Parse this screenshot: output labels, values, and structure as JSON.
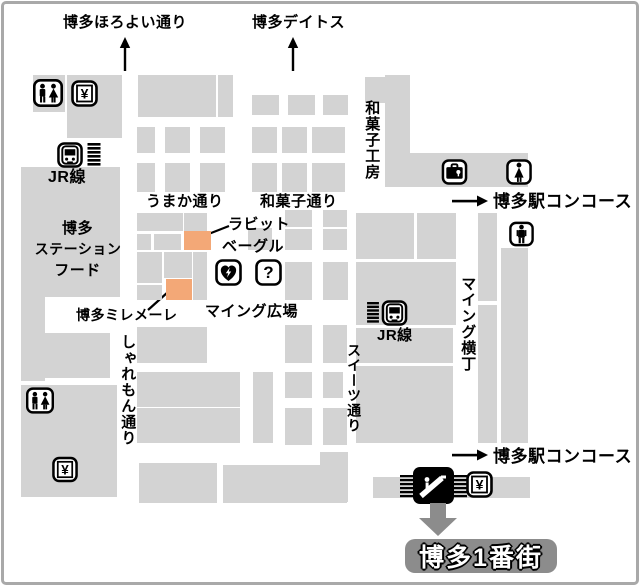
{
  "map": {
    "title": "博多駅 マイング 構内マップ",
    "destination_badge": "博多1番街",
    "colors": {
      "building": "#d3d3d3",
      "highlight": "#f3a877",
      "badge": "#8c8c8c",
      "arrow_gray": "#8c8c8c",
      "frame_border": "#a9a9a9",
      "ink": "#000000"
    },
    "labels": [
      {
        "id": "horoyoi-dori",
        "text": "博多ほろよい通り",
        "x": 63,
        "y": 14,
        "fs": 15
      },
      {
        "id": "deitos",
        "text": "博多デイトス",
        "x": 252,
        "y": 14,
        "fs": 15
      },
      {
        "id": "wagashi-kobo",
        "text": "和菓子工房",
        "x": 363,
        "y": 100,
        "fs": 15,
        "v": 1
      },
      {
        "id": "jr-line-left",
        "text": "JR線",
        "x": 48,
        "y": 169,
        "fs": 16
      },
      {
        "id": "umaka-dori",
        "text": "うまか通り",
        "x": 146,
        "y": 193,
        "fs": 15
      },
      {
        "id": "wagashi-dori",
        "text": "和菓子通り",
        "x": 260,
        "y": 193,
        "fs": 15
      },
      {
        "id": "concourse-top",
        "text": "博多駅コンコース",
        "x": 493,
        "y": 192,
        "fs": 17
      },
      {
        "id": "rabbit-bagel-1",
        "text": "ラビット",
        "x": 228,
        "y": 216,
        "fs": 15
      },
      {
        "id": "rabbit-bagel-2",
        "text": "ベーグル",
        "x": 222,
        "y": 238,
        "fs": 15
      },
      {
        "id": "station-food-1",
        "text": "博多",
        "x": 40,
        "y": 220,
        "fs": 15,
        "w": 75
      },
      {
        "id": "station-food-2",
        "text": "ステーション",
        "x": 33,
        "y": 241,
        "fs": 14,
        "w": 90
      },
      {
        "id": "station-food-3",
        "text": "フード",
        "x": 40,
        "y": 262,
        "fs": 15,
        "w": 75
      },
      {
        "id": "hakata-millemele",
        "text": "博多ミレメーレ",
        "x": 76,
        "y": 307,
        "fs": 14
      },
      {
        "id": "maing-hiroba",
        "text": "マイング広場",
        "x": 205,
        "y": 303,
        "fs": 15
      },
      {
        "id": "sharemon-dori",
        "text": "しゃれもん通り",
        "x": 119,
        "y": 334,
        "fs": 15,
        "v": 1
      },
      {
        "id": "maing-yokocho",
        "text": "マイング横丁",
        "x": 459,
        "y": 276,
        "fs": 15,
        "v": 1
      },
      {
        "id": "jr-line-right",
        "text": "JR線",
        "x": 377,
        "y": 327,
        "fs": 15
      },
      {
        "id": "sweets-dori",
        "text": "スイーツ通り",
        "x": 346,
        "y": 343,
        "fs": 14,
        "v": 1
      },
      {
        "id": "concourse-bottom",
        "text": "博多駅コンコース",
        "x": 493,
        "y": 447,
        "fs": 17
      }
    ],
    "highlights": [
      {
        "id": "rabbit-bagel",
        "label": "ラビットベーグル",
        "x": 184,
        "y": 231,
        "w": 27,
        "h": 19
      },
      {
        "id": "hakata-millemele",
        "label": "博多ミレメーレ",
        "x": 166,
        "y": 279,
        "w": 26,
        "h": 21
      }
    ],
    "leader_lines": [
      {
        "x1": 206,
        "y1": 235,
        "x2": 229,
        "y2": 226
      },
      {
        "x1": 148,
        "y1": 310,
        "x2": 168,
        "y2": 292
      }
    ],
    "icons": [
      {
        "type": "up-arrow",
        "x": 117,
        "y": 37,
        "w": 16,
        "h": 34
      },
      {
        "type": "up-arrow",
        "x": 285,
        "y": 37,
        "w": 16,
        "h": 34
      },
      {
        "type": "restroom",
        "x": 33,
        "y": 79,
        "w": 30,
        "h": 28
      },
      {
        "type": "yen",
        "x": 71,
        "y": 80,
        "w": 27,
        "h": 27
      },
      {
        "type": "train",
        "x": 56,
        "y": 142,
        "w": 28,
        "h": 26
      },
      {
        "type": "stairs",
        "x": 87,
        "y": 143,
        "w": 14,
        "h": 23
      },
      {
        "type": "coin-locker",
        "x": 441,
        "y": 159,
        "w": 27,
        "h": 26
      },
      {
        "type": "woman",
        "x": 506,
        "y": 159,
        "w": 26,
        "h": 26
      },
      {
        "type": "right-arrow",
        "x": 452,
        "y": 193,
        "w": 36,
        "h": 16
      },
      {
        "type": "man",
        "x": 509,
        "y": 221,
        "w": 25,
        "h": 26
      },
      {
        "type": "aed",
        "x": 215,
        "y": 259,
        "w": 27,
        "h": 27
      },
      {
        "type": "question",
        "x": 255,
        "y": 259,
        "w": 27,
        "h": 27
      },
      {
        "type": "stairs",
        "x": 366,
        "y": 302,
        "w": 14,
        "h": 21
      },
      {
        "type": "train",
        "x": 381,
        "y": 300,
        "w": 27,
        "h": 26
      },
      {
        "type": "restroom",
        "x": 26,
        "y": 387,
        "w": 28,
        "h": 27
      },
      {
        "type": "yen",
        "x": 52,
        "y": 456,
        "w": 26,
        "h": 27
      },
      {
        "type": "right-arrow",
        "x": 452,
        "y": 447,
        "w": 36,
        "h": 16
      },
      {
        "type": "escalator",
        "x": 400,
        "y": 467,
        "w": 67,
        "h": 38
      },
      {
        "type": "yen",
        "x": 466,
        "y": 471,
        "w": 27,
        "h": 27
      },
      {
        "type": "down-arrow",
        "x": 418,
        "y": 503,
        "w": 40,
        "h": 34
      }
    ],
    "buildings": [
      {
        "x": 33,
        "y": 75,
        "w": 32,
        "h": 37
      },
      {
        "x": 67,
        "y": 75,
        "w": 55,
        "h": 63
      },
      {
        "x": 138,
        "y": 75,
        "w": 78,
        "h": 42
      },
      {
        "x": 218,
        "y": 75,
        "w": 15,
        "h": 42
      },
      {
        "x": 252,
        "y": 95,
        "w": 27,
        "h": 20
      },
      {
        "x": 288,
        "y": 95,
        "w": 27,
        "h": 20
      },
      {
        "x": 323,
        "y": 95,
        "w": 25,
        "h": 20
      },
      {
        "x": 137,
        "y": 127,
        "w": 18,
        "h": 26
      },
      {
        "x": 165,
        "y": 127,
        "w": 25,
        "h": 26
      },
      {
        "x": 200,
        "y": 127,
        "w": 25,
        "h": 26
      },
      {
        "x": 252,
        "y": 127,
        "w": 25,
        "h": 26
      },
      {
        "x": 282,
        "y": 127,
        "w": 25,
        "h": 26
      },
      {
        "x": 312,
        "y": 127,
        "w": 33,
        "h": 26
      },
      {
        "x": 137,
        "y": 163,
        "w": 18,
        "h": 29
      },
      {
        "x": 165,
        "y": 163,
        "w": 25,
        "h": 29
      },
      {
        "x": 200,
        "y": 163,
        "w": 25,
        "h": 29
      },
      {
        "x": 252,
        "y": 163,
        "w": 25,
        "h": 29
      },
      {
        "x": 282,
        "y": 163,
        "w": 25,
        "h": 29
      },
      {
        "x": 312,
        "y": 163,
        "w": 33,
        "h": 29
      },
      {
        "x": 365,
        "y": 77,
        "w": 20,
        "h": 26
      },
      {
        "x": 385,
        "y": 75,
        "w": 25,
        "h": 112
      },
      {
        "x": 385,
        "y": 153,
        "w": 143,
        "h": 34
      },
      {
        "x": 21,
        "y": 167,
        "w": 99,
        "h": 130
      },
      {
        "x": 21,
        "y": 297,
        "w": 24,
        "h": 84
      },
      {
        "x": 44,
        "y": 333,
        "w": 66,
        "h": 45
      },
      {
        "x": 21,
        "y": 385,
        "w": 96,
        "h": 112
      },
      {
        "x": 137,
        "y": 213,
        "w": 46,
        "h": 18
      },
      {
        "x": 137,
        "y": 234,
        "w": 14,
        "h": 16
      },
      {
        "x": 154,
        "y": 234,
        "w": 27,
        "h": 16
      },
      {
        "x": 184,
        "y": 213,
        "w": 23,
        "h": 18
      },
      {
        "x": 248,
        "y": 228,
        "w": 24,
        "h": 22
      },
      {
        "x": 285,
        "y": 210,
        "w": 27,
        "h": 17
      },
      {
        "x": 323,
        "y": 210,
        "w": 24,
        "h": 17
      },
      {
        "x": 285,
        "y": 229,
        "w": 27,
        "h": 21
      },
      {
        "x": 323,
        "y": 229,
        "w": 24,
        "h": 21
      },
      {
        "x": 137,
        "y": 252,
        "w": 25,
        "h": 31
      },
      {
        "x": 137,
        "y": 285,
        "w": 25,
        "h": 15
      },
      {
        "x": 164,
        "y": 252,
        "w": 28,
        "h": 26
      },
      {
        "x": 193,
        "y": 252,
        "w": 14,
        "h": 48
      },
      {
        "x": 285,
        "y": 262,
        "w": 27,
        "h": 38
      },
      {
        "x": 323,
        "y": 262,
        "w": 25,
        "h": 38
      },
      {
        "x": 356,
        "y": 213,
        "w": 58,
        "h": 46
      },
      {
        "x": 417,
        "y": 213,
        "w": 39,
        "h": 46
      },
      {
        "x": 356,
        "y": 262,
        "w": 100,
        "h": 63
      },
      {
        "x": 356,
        "y": 328,
        "w": 97,
        "h": 35
      },
      {
        "x": 356,
        "y": 366,
        "w": 97,
        "h": 77
      },
      {
        "x": 478,
        "y": 213,
        "w": 19,
        "h": 88
      },
      {
        "x": 478,
        "y": 305,
        "w": 19,
        "h": 138
      },
      {
        "x": 501,
        "y": 248,
        "w": 27,
        "h": 195
      },
      {
        "x": 137,
        "y": 327,
        "w": 70,
        "h": 36
      },
      {
        "x": 285,
        "y": 325,
        "w": 27,
        "h": 38
      },
      {
        "x": 323,
        "y": 325,
        "w": 24,
        "h": 38
      },
      {
        "x": 137,
        "y": 372,
        "w": 103,
        "h": 35
      },
      {
        "x": 253,
        "y": 372,
        "w": 20,
        "h": 71
      },
      {
        "x": 285,
        "y": 372,
        "w": 27,
        "h": 26
      },
      {
        "x": 323,
        "y": 372,
        "w": 20,
        "h": 26
      },
      {
        "x": 137,
        "y": 408,
        "w": 103,
        "h": 35
      },
      {
        "x": 285,
        "y": 408,
        "w": 27,
        "h": 37
      },
      {
        "x": 323,
        "y": 408,
        "w": 24,
        "h": 37
      },
      {
        "x": 320,
        "y": 452,
        "w": 28,
        "h": 50
      },
      {
        "x": 139,
        "y": 463,
        "w": 78,
        "h": 40
      },
      {
        "x": 223,
        "y": 465,
        "w": 124,
        "h": 38
      },
      {
        "x": 373,
        "y": 477,
        "w": 157,
        "h": 21
      }
    ]
  }
}
